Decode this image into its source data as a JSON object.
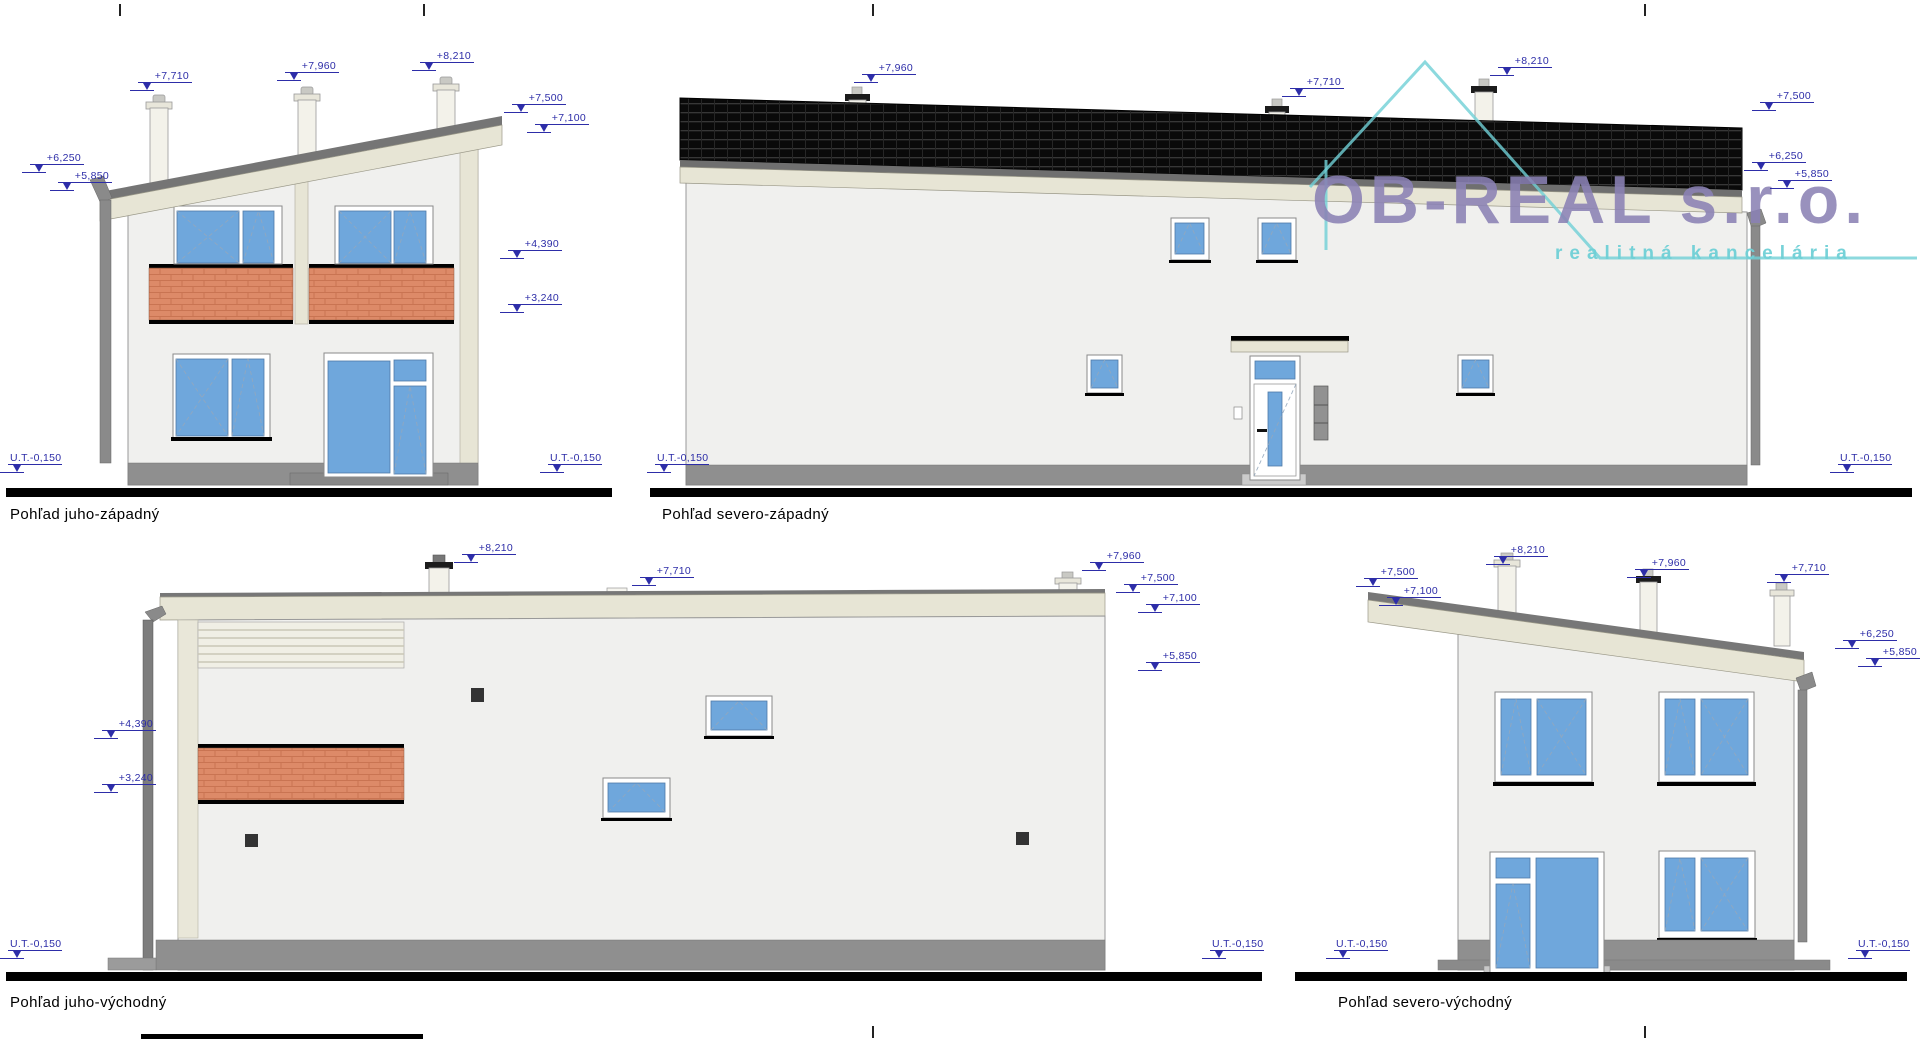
{
  "logo": {
    "name": "OB-REAL s.r.o.",
    "tagline": "realitná kancelária"
  },
  "colors": {
    "dimension": "#2d2da8",
    "wall": "#f0f0ee",
    "trim": "#e7e5d5",
    "brick": "#dd8a68",
    "glass": "#6fa7dc",
    "plinth": "#8f8f8f",
    "roof_tiles": "#0a0a0a",
    "logo_purple": "#8b82b5",
    "logo_teal": "#6fd0d6"
  },
  "elevations": {
    "sw": {
      "title": "Pohľad juho-západný",
      "labels": [
        {
          "text": "+7,710"
        },
        {
          "text": "+7,960"
        },
        {
          "text": "+8,210"
        },
        {
          "text": "+7,500"
        },
        {
          "text": "+7,100"
        },
        {
          "text": "+6,250"
        },
        {
          "text": "+5,850"
        },
        {
          "text": "+4,390"
        },
        {
          "text": "+3,240"
        },
        {
          "text": "U.T.-0,150"
        },
        {
          "text": "U.T.-0,150"
        }
      ]
    },
    "nw": {
      "title": "Pohľad severo-západný",
      "labels": [
        {
          "text": "+7,960"
        },
        {
          "text": "+7,710"
        },
        {
          "text": "+8,210"
        },
        {
          "text": "+7,500"
        },
        {
          "text": "+6,250"
        },
        {
          "text": "+5,850"
        },
        {
          "text": "U.T.-0,150"
        },
        {
          "text": "U.T.-0,150"
        }
      ]
    },
    "se": {
      "title": "Pohľad juho-východný",
      "labels": [
        {
          "text": "+8,210"
        },
        {
          "text": "+7,710"
        },
        {
          "text": "+7,960"
        },
        {
          "text": "+7,500"
        },
        {
          "text": "+7,100"
        },
        {
          "text": "+5,850"
        },
        {
          "text": "+4,390"
        },
        {
          "text": "+3,240"
        },
        {
          "text": "U.T.-0,150"
        },
        {
          "text": "U.T.-0,150"
        }
      ]
    },
    "ne": {
      "title": "Pohľad severo-východný",
      "labels": [
        {
          "text": "+7,500"
        },
        {
          "text": "+7,100"
        },
        {
          "text": "+8,210"
        },
        {
          "text": "+7,960"
        },
        {
          "text": "+7,710"
        },
        {
          "text": "+6,250"
        },
        {
          "text": "+5,850"
        },
        {
          "text": "U.T.-0,150"
        },
        {
          "text": "U.T.-0,150"
        }
      ]
    }
  }
}
